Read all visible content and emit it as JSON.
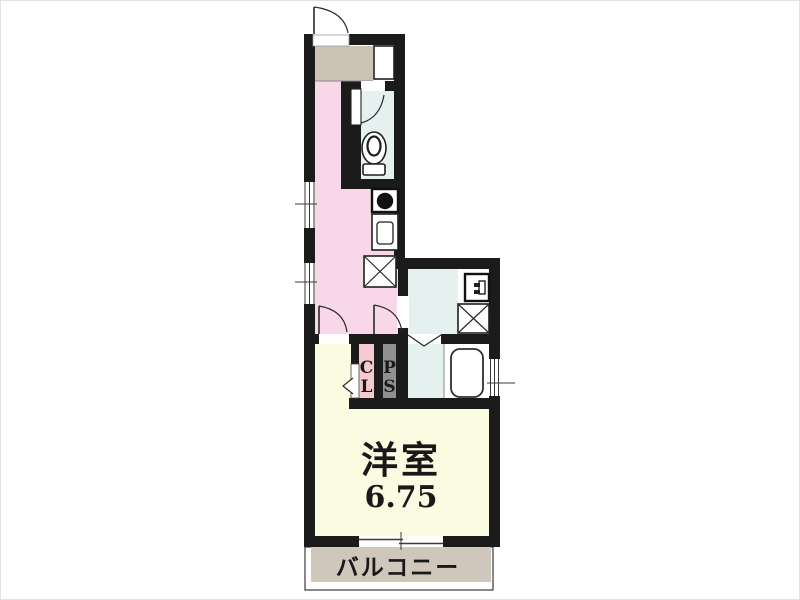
{
  "floorplan": {
    "rooms": {
      "western_room": {
        "label": "洋室",
        "area": "6.75"
      },
      "balcony": {
        "label": "バルコニー"
      },
      "closet": {
        "chars": [
          "C",
          "L"
        ]
      },
      "pipe_space": {
        "chars": [
          "P",
          "S"
        ]
      }
    },
    "colors": {
      "wall": "#1b1b1b",
      "hallway_kitchen": "#f8d8e8",
      "wet_area": "#e4f1ee",
      "western_room": "#fbfbe2",
      "entry": "#ccc2b5",
      "balcony": "#cfc7bb",
      "closet": "#f5c9cf",
      "pipe_space": "#909090",
      "fixture_white": "#ffffff"
    }
  }
}
